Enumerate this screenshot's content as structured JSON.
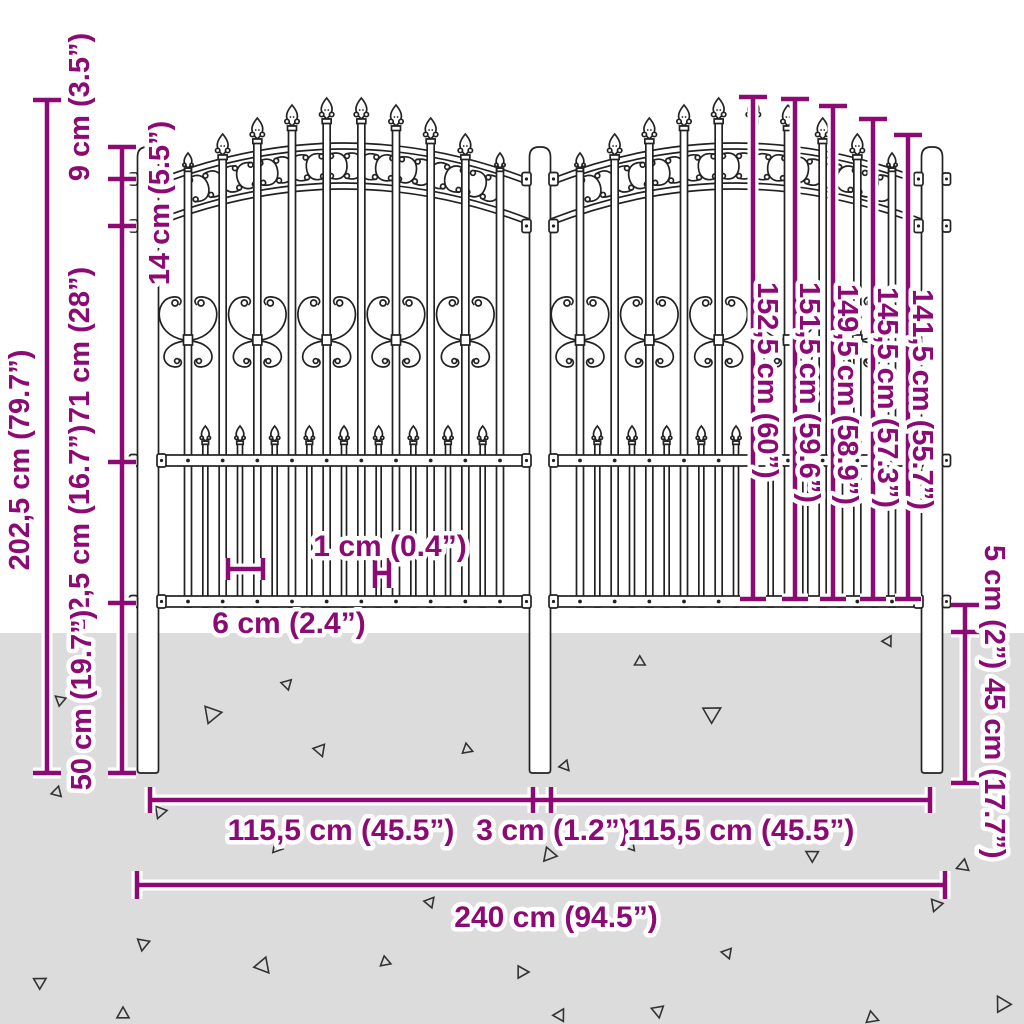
{
  "diagram_title": "Garden fence with spear top - dimension diagram",
  "colors": {
    "dimension": "#8B0A74",
    "ground": "#DCDCDC",
    "fence_line": "#222222"
  },
  "dimensions": {
    "total_height": "202,5 cm (79.7”)",
    "post_above_band": "9 cm (3.5”)",
    "band_height": "14 cm (5.5”)",
    "upper_section": "71 cm (28”)",
    "lower_section": "42,5 cm (16.7”)",
    "below_ground": "50 cm (19.7”)",
    "picket_heights": [
      "152,5 cm (60”)",
      "151,5 cm (59.6”)",
      "149,5 cm (58.9”)",
      "145,5 cm (57.3”)",
      "141,5 cm (55.7”)"
    ],
    "ground_clearance": "5 cm (2”)",
    "post_underground": "45 cm (17.7”)",
    "picket_spacing": "6 cm (2.4”)",
    "picket_thickness": "1 cm (0.4”)",
    "left_panel_width": "115,5 cm (45.5”)",
    "center_post_gap": "3 cm (1.2”)",
    "right_panel_width": "115,5 cm (45.5”)",
    "total_width": "240 cm (94.5”)"
  }
}
